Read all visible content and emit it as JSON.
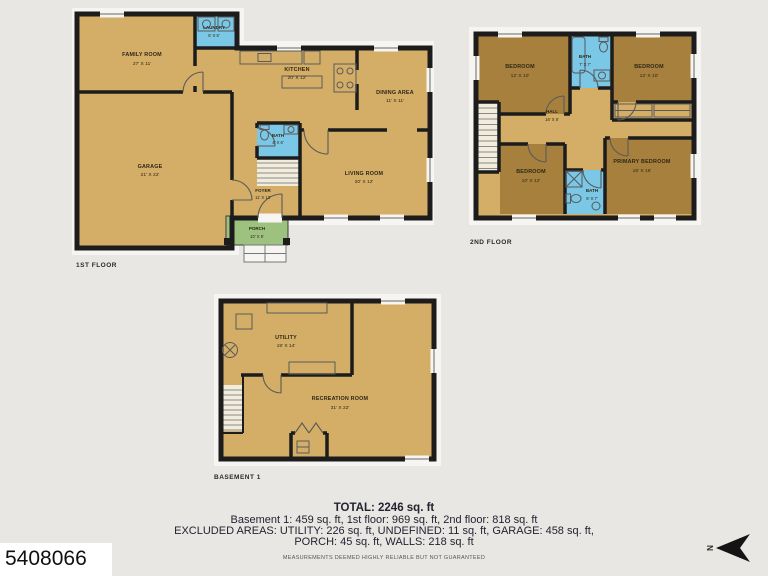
{
  "page": {
    "listing_id": "5408066",
    "north_label": "N",
    "background": "#e8e7e4"
  },
  "colors": {
    "wall": "#1c1c1c",
    "floor_tan": "#d4ae66",
    "bedroom_brown": "#a8803e",
    "bath_blue": "#7ac7e6",
    "porch_green": "#9dc17f",
    "stairs_light": "#f2ecdc"
  },
  "floors": [
    {
      "name": "1ST FLOOR",
      "rooms": [
        {
          "label": "FAMILY ROOM",
          "dims": "27' X 11'"
        },
        {
          "label": "LAUNDRY",
          "dims": "6' X 5'"
        },
        {
          "label": "KITCHEN",
          "dims": "20' X 12'"
        },
        {
          "label": "DINING AREA",
          "dims": "11' X 11'"
        },
        {
          "label": "GARAGE",
          "dims": "21' X 22'"
        },
        {
          "label": "BATH",
          "dims": "4' X 6'"
        },
        {
          "label": "LIVING ROOM",
          "dims": "20' X 12'"
        },
        {
          "label": "FOYER",
          "dims": "11' X 13'"
        },
        {
          "label": "PORCH",
          "dims": "10' X 5'"
        }
      ]
    },
    {
      "name": "2ND FLOOR",
      "rooms": [
        {
          "label": "BEDROOM",
          "dims": "12' X 10'"
        },
        {
          "label": "BATH",
          "dims": "7' X 7'"
        },
        {
          "label": "BEDROOM",
          "dims": "12' X 10'"
        },
        {
          "label": "HALL",
          "dims": "16' X 6'"
        },
        {
          "label": "BEDROOM",
          "dims": "10' X 12'"
        },
        {
          "label": "BATH",
          "dims": "6' X 7'"
        },
        {
          "label": "PRIMARY BEDROOM",
          "dims": "15' X 16'"
        }
      ]
    },
    {
      "name": "BASEMENT 1",
      "rooms": [
        {
          "label": "UTILITY",
          "dims": "19' X 14'"
        },
        {
          "label": "RECREATION ROOM",
          "dims": "31' X 22'"
        }
      ]
    }
  ],
  "summary": {
    "total": "TOTAL: 2246 sq. ft",
    "floors_line": "Basement 1: 459 sq. ft, 1st floor: 969 sq. ft, 2nd floor: 818 sq. ft",
    "excluded_line1": "EXCLUDED AREAS: UTILITY: 226 sq. ft, UNDEFINED: 11 sq. ft, GARAGE: 458 sq. ft,",
    "excluded_line2": "PORCH: 45 sq. ft, WALLS: 218 sq. ft",
    "disclaimer": "MEASUREMENTS DEEMED HIGHLY RELIABLE BUT NOT GUARANTEED"
  }
}
